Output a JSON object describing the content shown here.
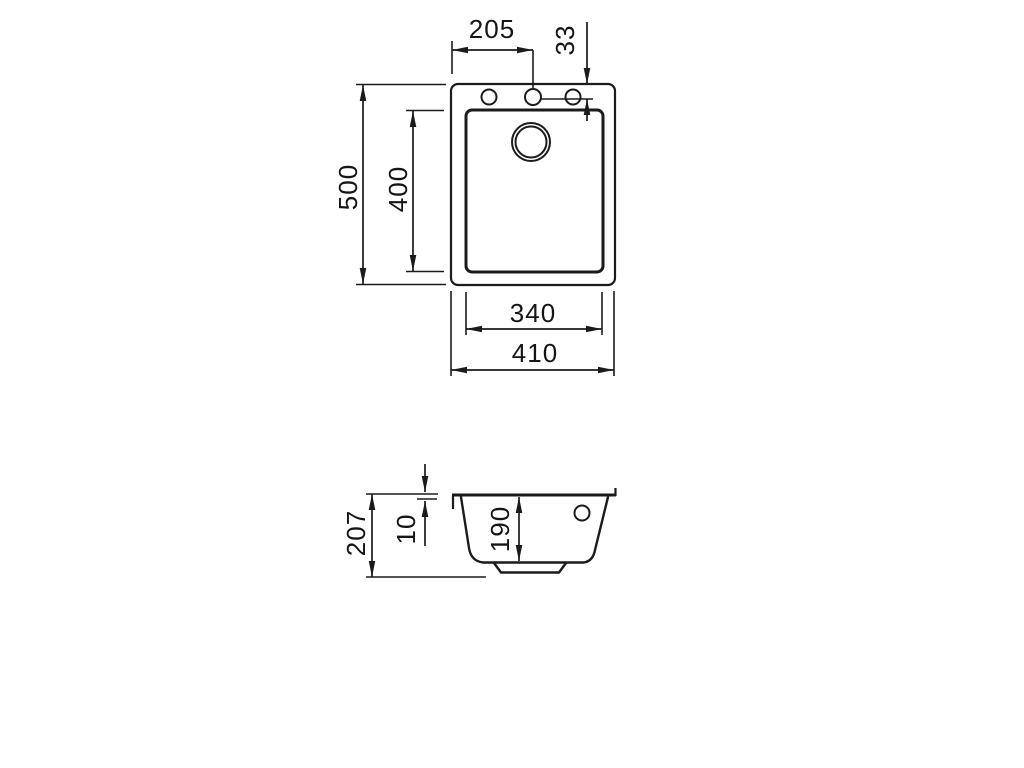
{
  "page": {
    "background": "#ffffff",
    "line_color": "#1b1b1b"
  },
  "top_view": {
    "description": "sink plan view with bowl, three tap holes and drain",
    "dims": {
      "tap_center_offset": "205",
      "tap_edge_offset": "33",
      "outer_depth": "500",
      "bowl_depth": "400",
      "bowl_width": "340",
      "outer_width": "410"
    }
  },
  "section_view": {
    "description": "sink cross section with bowl depth and rim",
    "dims": {
      "total_height": "207",
      "rim_height": "10",
      "bowl_inner_depth": "190"
    }
  }
}
